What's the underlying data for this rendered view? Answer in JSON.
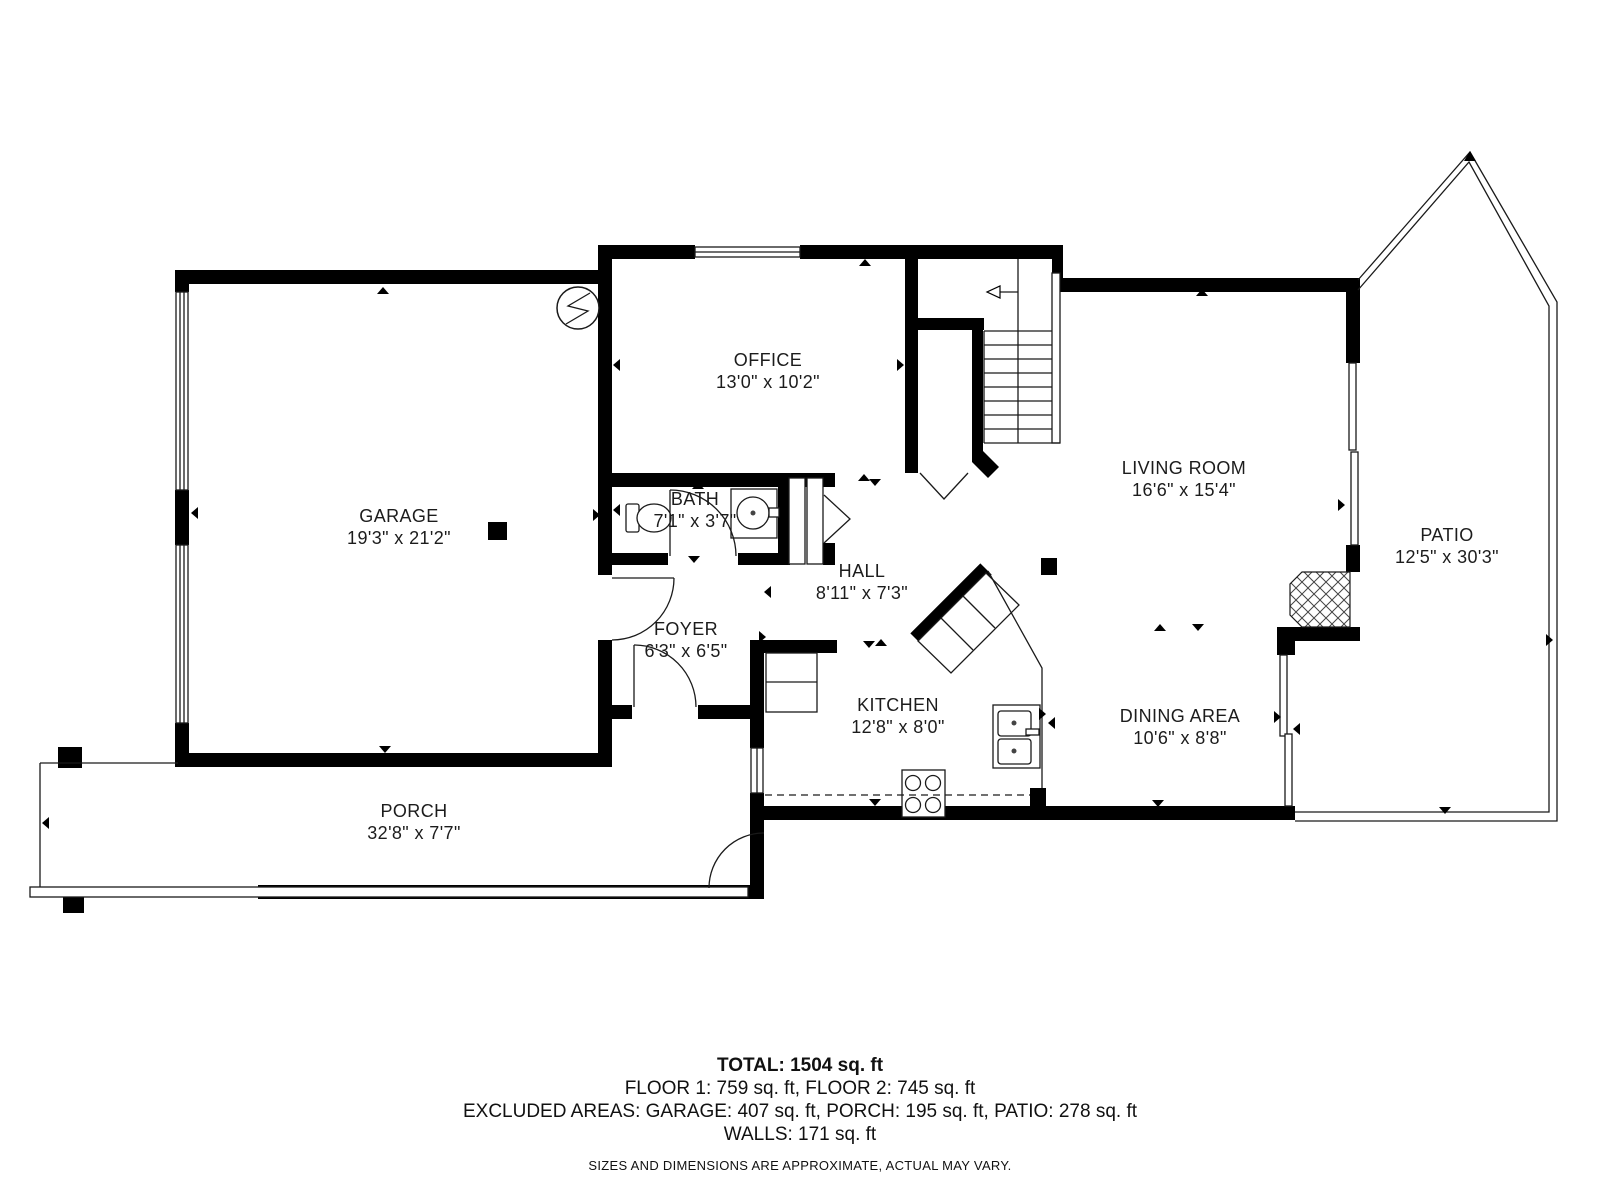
{
  "rooms": {
    "garage": {
      "name": "GARAGE",
      "dims": "19'3\" x 21'2\""
    },
    "office": {
      "name": "OFFICE",
      "dims": "13'0\" x 10'2\""
    },
    "bath": {
      "name": "BATH",
      "dims": "7'1\" x 3'7\""
    },
    "hall": {
      "name": "HALL",
      "dims": "8'11\" x 7'3\""
    },
    "foyer": {
      "name": "FOYER",
      "dims": "6'3\" x 6'5\""
    },
    "kitchen": {
      "name": "KITCHEN",
      "dims": "12'8\" x 8'0\""
    },
    "living_room": {
      "name": "LIVING ROOM",
      "dims": "16'6\" x 15'4\""
    },
    "dining_area": {
      "name": "DINING AREA",
      "dims": "10'6\" x 8'8\""
    },
    "patio": {
      "name": "PATIO",
      "dims": "12'5\" x 30'3\""
    },
    "porch": {
      "name": "PORCH",
      "dims": "32'8\" x 7'7\""
    }
  },
  "summary": {
    "total": "TOTAL: 1504 sq. ft",
    "floors": "FLOOR 1: 759 sq. ft, FLOOR 2: 745 sq. ft",
    "excluded_areas": "EXCLUDED AREAS: GARAGE: 407 sq. ft, PORCH: 195 sq. ft, PATIO: 278 sq. ft",
    "walls": "WALLS: 171 sq. ft",
    "disclaimer": "SIZES AND DIMENSIONS ARE APPROXIMATE, ACTUAL MAY VARY."
  },
  "icons": {
    "electrical_symbol": "circle-with-zigzag",
    "stairs_direction": "arrow-up-to-second-floor"
  },
  "colors": {
    "wall": "#000000",
    "background": "#ffffff",
    "text": "#1c1c1c"
  }
}
